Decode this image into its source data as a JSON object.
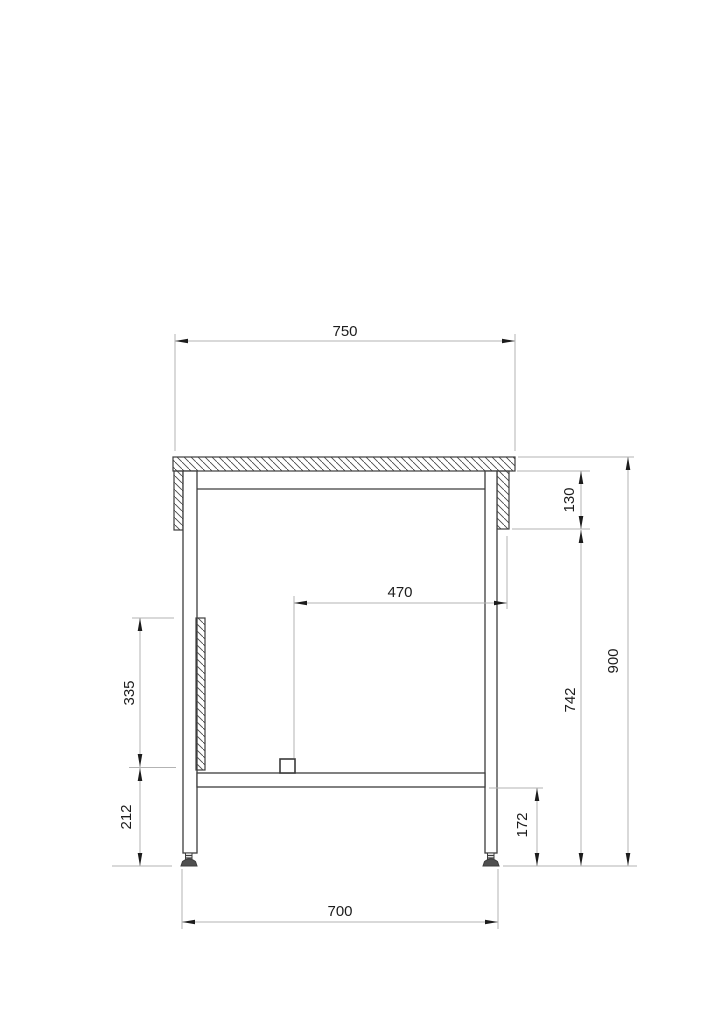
{
  "drawing": {
    "description": "Side section technical drawing of a table / workbench frame with hatched tabletop, aprons, side panel, lower shelf and levelling feet",
    "units": "mm",
    "dims": {
      "top_width": "750",
      "apron_height": "130",
      "inner_clearance": "470",
      "overall_height": "900",
      "underframe_height": "742",
      "side_panel_height": "335",
      "panel_to_floor": "212",
      "shelf_to_floor": "172",
      "leg_spacing": "700"
    },
    "colors": {
      "background": "#ffffff",
      "object_line": "#3d3d3d",
      "dimension_line": "#b3b3b3",
      "arrow_and_text": "#1c1c1c",
      "foot_fill": "#4f4f4f"
    }
  }
}
